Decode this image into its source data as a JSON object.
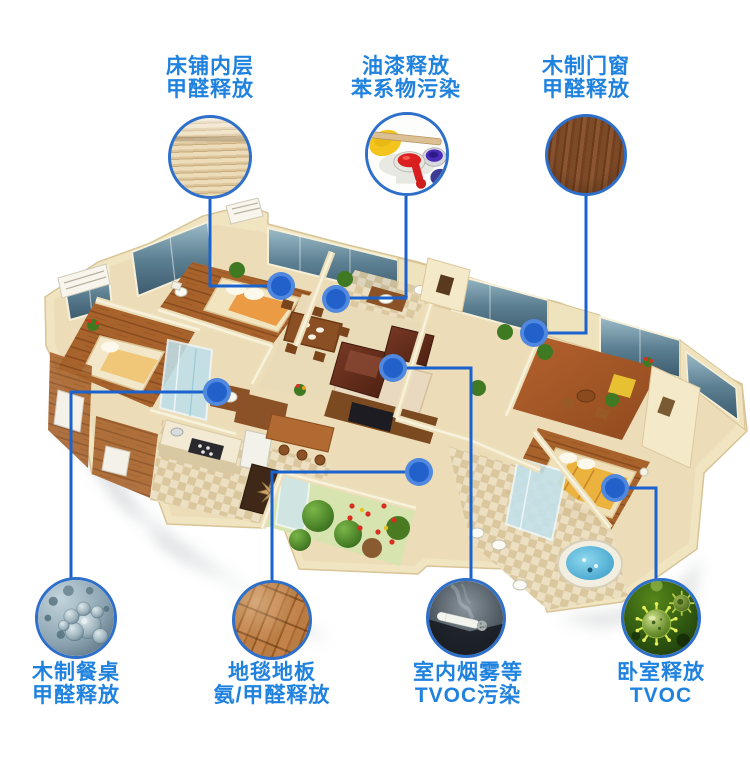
{
  "page": {
    "background": "#ffffff",
    "type": "indoor-pollution-sources-infographic"
  },
  "colors": {
    "label_text": "#1f82de",
    "connector_line": "#1a63cf",
    "dot_inner": "#2161c9",
    "dot_ring": "#4f88de",
    "circle_border": "#2e6fca"
  },
  "callouts": {
    "top": [
      {
        "line1": "床铺内层",
        "line2": "甲醛释放",
        "image": "bed-slats-photo"
      },
      {
        "line1": "油漆释放",
        "line2": "苯系物污染",
        "image": "paint-cans-photo"
      },
      {
        "line1": "木制门窗",
        "line2": "甲醛释放",
        "image": "dark-wood-grain-photo"
      }
    ],
    "bottom": [
      {
        "line1": "木制餐桌",
        "line2": "甲醛释放",
        "image": "molecule-spheres-photo"
      },
      {
        "line1": "地毯地板",
        "line2": "氨/甲醛释放",
        "image": "wood-floor-planks-photo"
      },
      {
        "line1": "室内烟雾等",
        "line2": "TVOC污染",
        "image": "cigarette-smoke-photo"
      },
      {
        "line1": "卧室释放",
        "line2": "TVOC",
        "image": "green-virus-photo"
      }
    ]
  }
}
